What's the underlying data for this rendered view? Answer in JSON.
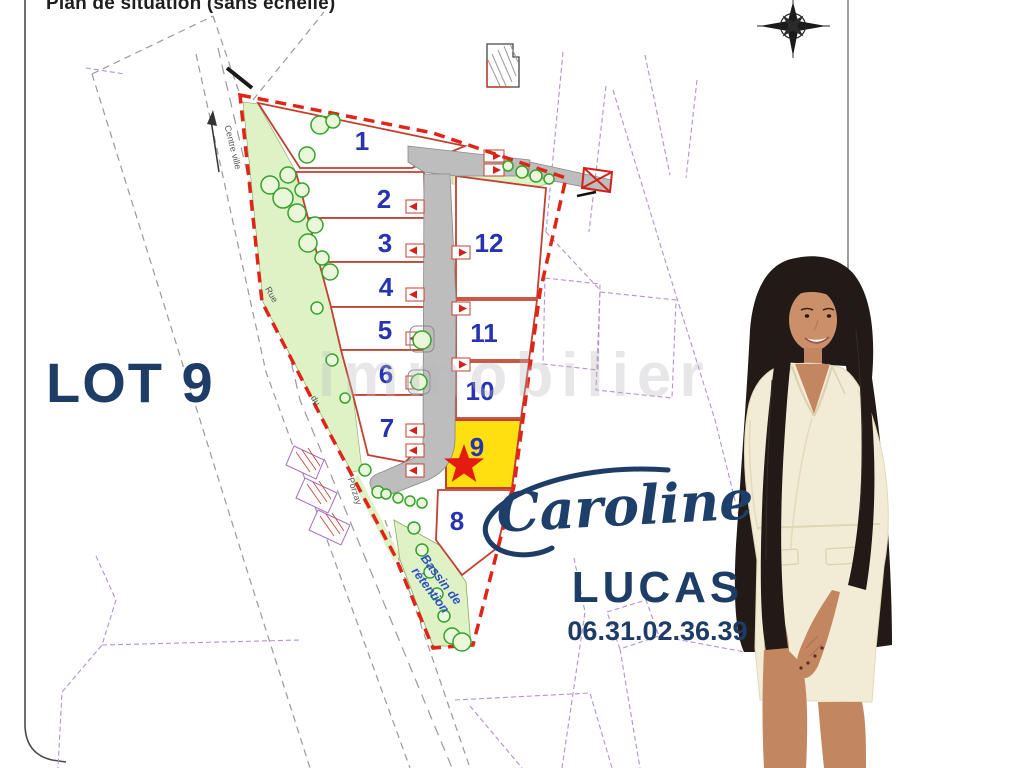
{
  "header": {
    "title": "Plan de situation (sans échelle)"
  },
  "lot_callout": "LOT 9",
  "watermark": "immobilier",
  "agent": {
    "first_name": "Caroline",
    "last_name": "LUCAS",
    "phone": "06.31.02.36.39"
  },
  "plan": {
    "lot_numbers": [
      "1",
      "2",
      "3",
      "4",
      "5",
      "6",
      "7",
      "8",
      "9",
      "10",
      "11",
      "12"
    ],
    "highlighted_lot": "9",
    "street": {
      "direction_label": "Centre ville",
      "name_parts": [
        "Rue",
        "du",
        "Porzay"
      ]
    },
    "bassin": {
      "line1": "Bassin de",
      "line2": "rétention"
    },
    "colors": {
      "boundary_red": "#e02417",
      "lot_line_red": "#c2402f",
      "lot_number_blue": "#2733b0",
      "highlight_yellow": "#ffdf0f",
      "green_area": "#def2c6",
      "tree_green": "#35a32a",
      "road_gray": "#bdbdbd",
      "cadastral_purple": "#b98fd0",
      "navy_text": "#1d3c66"
    }
  }
}
